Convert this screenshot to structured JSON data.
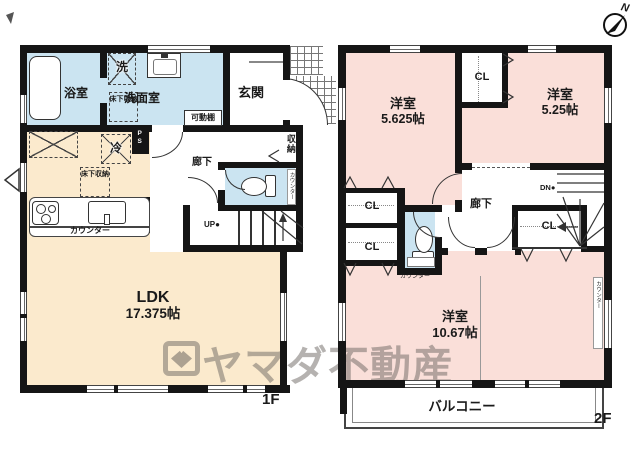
{
  "title": "間取り図",
  "colors": {
    "wall": "#151515",
    "ldk_fill": "#FBEACD",
    "bedroom_fill": "#FADFD9",
    "wet_area_fill": "#CBE4F1",
    "watermark": "rgba(107,101,97,0.5)"
  },
  "common": {
    "closet": "CL",
    "counter": "カウンター",
    "underfloor_storage": "床下収納",
    "hallway": "廊下",
    "western_room": "洋室"
  },
  "floor1": {
    "label": "1F",
    "bath": "浴室",
    "washer": "洗",
    "washroom": "洗面室",
    "movable_shelf": "可動棚",
    "entrance": "玄関",
    "storage": "収納",
    "fridge": "冷",
    "pipe_space": "PS",
    "stairs_up": "UP",
    "ldk_name": "LDK",
    "ldk_size": "17.375帖"
  },
  "floor2": {
    "label": "2F",
    "room1_size": "5.625帖",
    "room2_size": "5.25帖",
    "room3_size": "10.67帖",
    "stairs_down": "DN",
    "balcony": "バルコニー",
    "compass_north": "N"
  },
  "watermark": {
    "brand": "ヤマダ不動産"
  }
}
